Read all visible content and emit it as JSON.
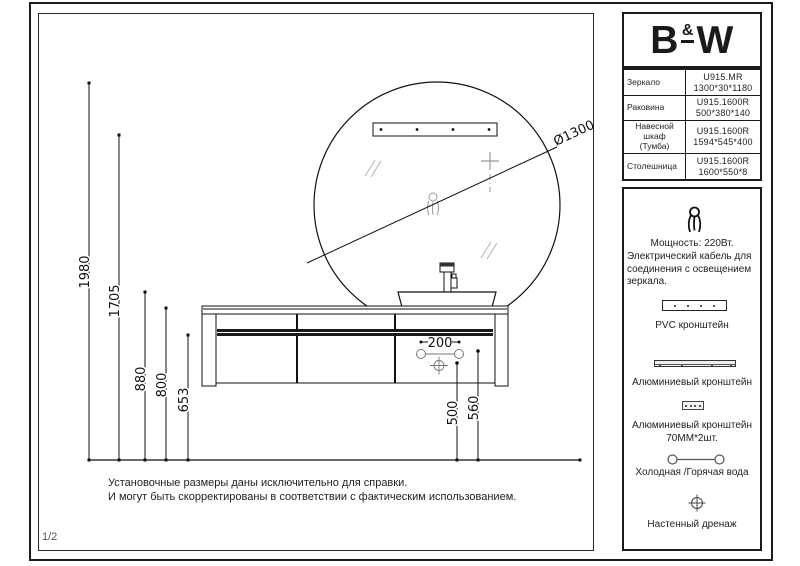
{
  "page": {
    "page_number": "1/2"
  },
  "logo": {
    "part1": "B",
    "part2": "&",
    "part3": "W"
  },
  "spec_table": {
    "rows": [
      {
        "label": "Зеркало",
        "value": "U915.MR\n1300*30*1180"
      },
      {
        "label": "Раковина",
        "value": "U915.1600R\n500*380*140"
      },
      {
        "label": "Навесной\nшкаф\n(Тумба)",
        "value": "U915.1600R\n1594*545*400"
      },
      {
        "label": "Столешница",
        "value": "U915.1600R\n1600*550*8"
      }
    ]
  },
  "info_panel": {
    "power_title": "Мощность: 220Вт.",
    "power_line1": "Электрический кабель для",
    "power_line2": "соединения с освещением",
    "power_line3": "зеркала.",
    "pvc_label": "PVC кронштейн",
    "alu_label_1": "Алюминиевый кронштейн",
    "alu_label_2": "Алюминиевый кронштейн",
    "alu_qty": "70ММ*2шт.",
    "water_label": "Холодная /Горячая вода",
    "drain_label": "Настенный дренаж"
  },
  "icons": {
    "cable": "power-cable-icon",
    "pvc_bracket": "pvc-bracket-icon",
    "alu_bracket": "aluminium-bracket-icon",
    "alu_bracket_small": "aluminium-bracket-small-icon",
    "water": "cold-hot-water-icon",
    "drain": "wall-drain-icon"
  },
  "dimensions": {
    "d1980": "1980",
    "d1705": "1705",
    "d880": "880",
    "d800": "800",
    "d653": "653",
    "d200": "200",
    "d500": "500",
    "d560": "560",
    "diameter": "Ø1300"
  },
  "notes": {
    "line1": "Установочные размеры даны исключительно для справки.",
    "line2": "И могут быть скорректированы в соответствии с фактическим использованием."
  }
}
